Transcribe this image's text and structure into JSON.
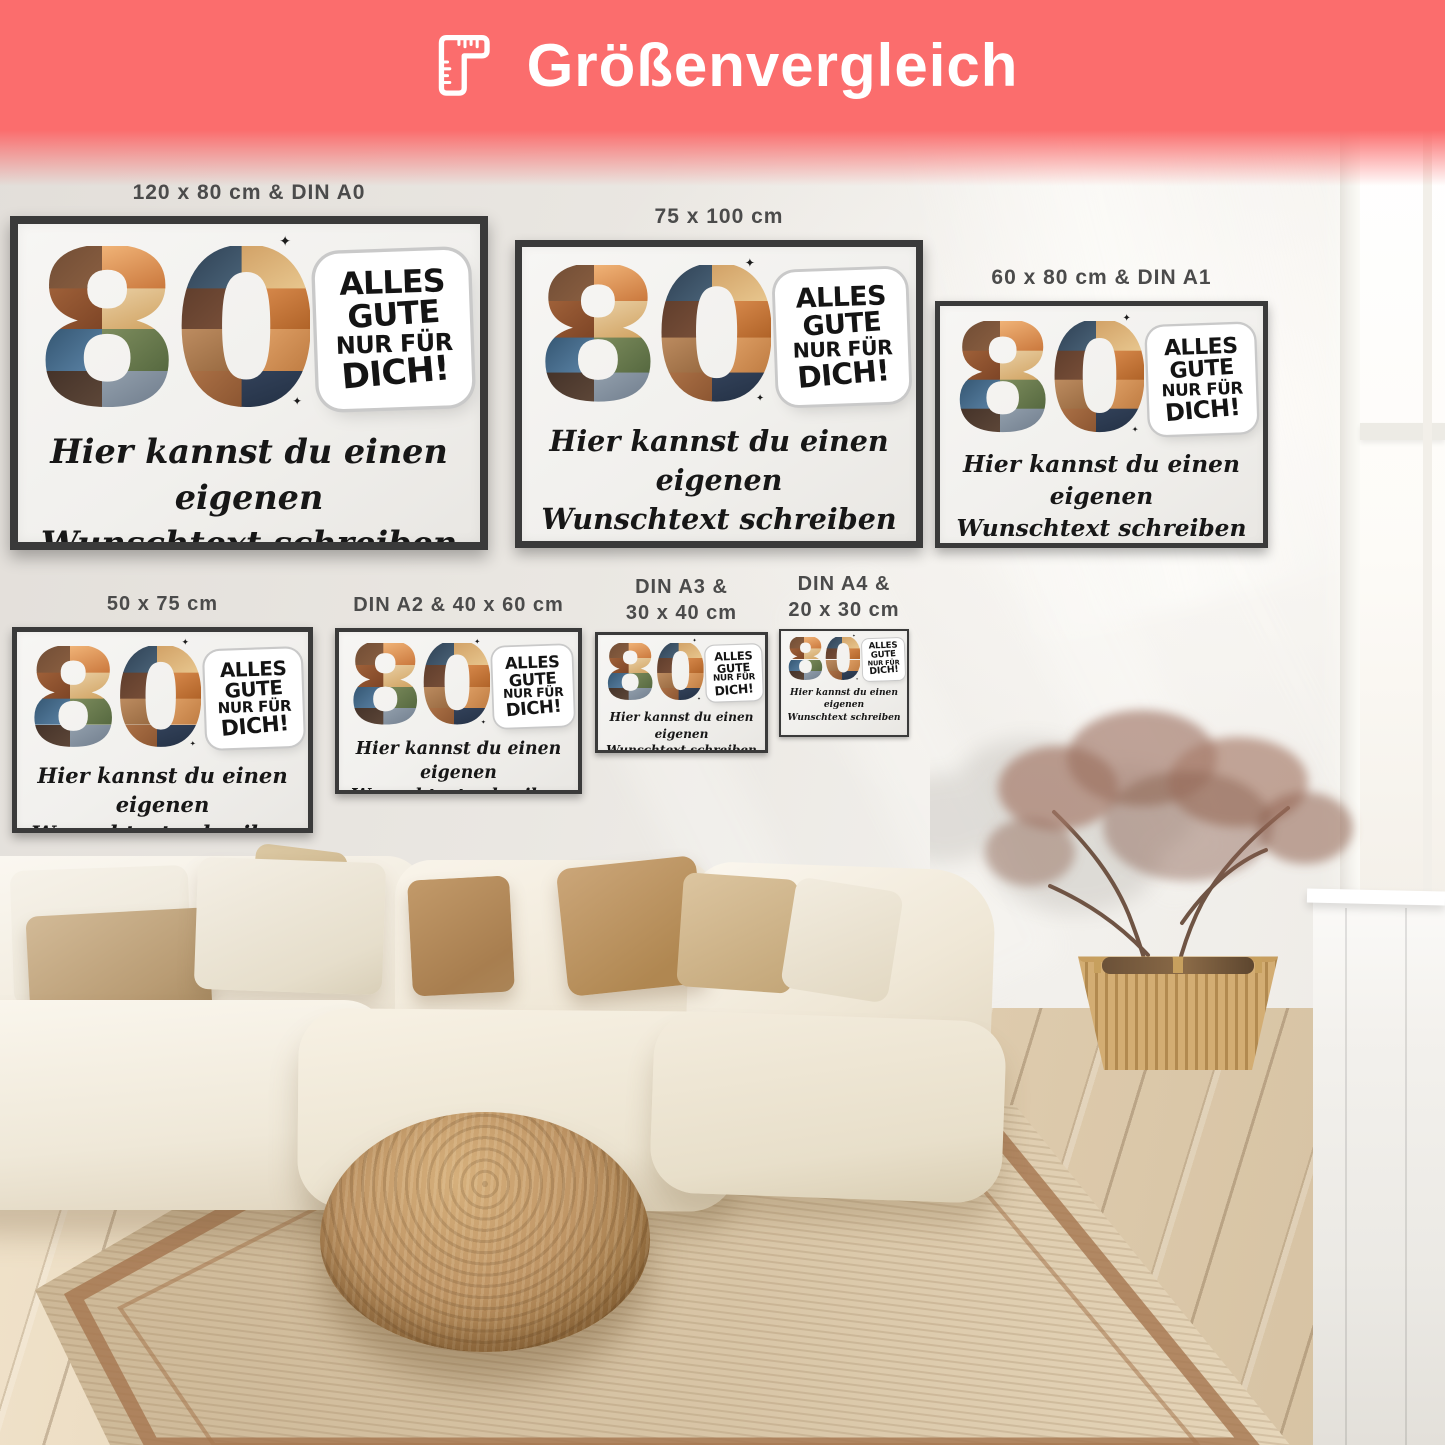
{
  "header": {
    "title": "Größenvergleich",
    "icon": "ruler-icon",
    "bg_color": "#fb6d6d",
    "text_color": "#ffffff"
  },
  "design": {
    "number": "80",
    "badge_lines": [
      "ALLES",
      "GUTE",
      "NUR FÜR",
      "DICH!"
    ],
    "custom_text": [
      "Hier kannst du einen eigenen",
      "Wunschtext schreiben"
    ],
    "sparkle": "✦"
  },
  "posters": [
    {
      "label1": "120 x 80 cm & DIN A0"
    },
    {
      "label1": "75 x 100 cm"
    },
    {
      "label1": "60 x 80 cm & DIN A1"
    },
    {
      "label1": "50 x 75 cm"
    },
    {
      "label1": "DIN A2 & 40 x 60 cm"
    },
    {
      "label1": "DIN A3 &",
      "label2": "30 x 40 cm"
    },
    {
      "label1": "DIN A4 &",
      "label2": "20 x 30 cm"
    }
  ],
  "colors": {
    "frame": "#3a3a3a",
    "paper": "#f3f2f0",
    "label_text": "#4b4b4b",
    "ink": "#151515",
    "wall": "#ece9e5",
    "sofa": "#f4eee2",
    "rattan": "#bd9363",
    "rug_border": "#a5764f"
  }
}
